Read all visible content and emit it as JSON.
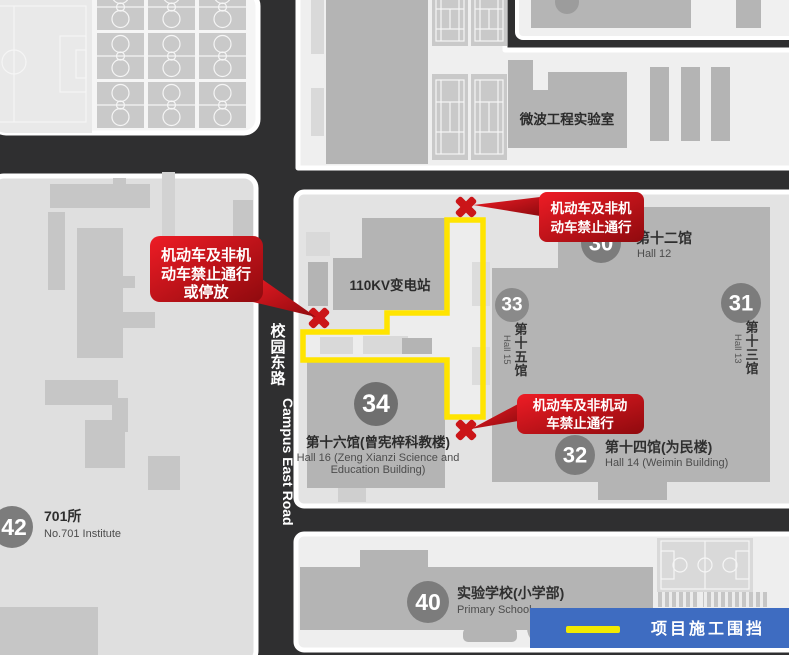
{
  "roads": {
    "name_cn": "校园东路",
    "name_en": "Campus East Road"
  },
  "legend": {
    "label": "项目施工围挡"
  },
  "colors": {
    "fence_yellow": "#ffe400",
    "warning_red": "#cb1518",
    "legend_blue": "#3e6cc1",
    "road_dark": "#2f2f30"
  },
  "warnings": {
    "top": [
      "机动车及非机",
      "动车禁止通行"
    ],
    "left": [
      "机动车及非机",
      "动车禁止通行",
      "或停放"
    ],
    "bottom": [
      "机动车及非机动",
      "车禁止通行"
    ]
  },
  "places": {
    "microwave_lab": {
      "name_cn": "微波工程实验室"
    },
    "substation": {
      "name_cn": "110KV变电站"
    },
    "hall12": {
      "num": "30",
      "name_cn": "第十二馆",
      "name_en": "Hall 12"
    },
    "hall13": {
      "num": "31",
      "name_cn": "第十三馆",
      "name_en": "Hall 13"
    },
    "hall14": {
      "num": "32",
      "name_cn": "第十四馆(为民楼)",
      "name_en": "Hall 14 (Weimin Building)"
    },
    "hall15": {
      "num": "33",
      "name_cn": "第十五馆",
      "name_en": "Hall 15"
    },
    "hall16": {
      "num": "34",
      "name_cn": "第十六馆(曾宪梓科教楼)",
      "name_en_1": "Hall 16 (Zeng Xianzi Science and",
      "name_en_2": "Education Building)"
    },
    "institute701": {
      "num": "42",
      "name_cn": "701所",
      "name_en": "No.701 Institute"
    },
    "primary_school": {
      "num": "40",
      "name_cn": "实验学校(小学部)",
      "name_en": "Primary School"
    }
  }
}
